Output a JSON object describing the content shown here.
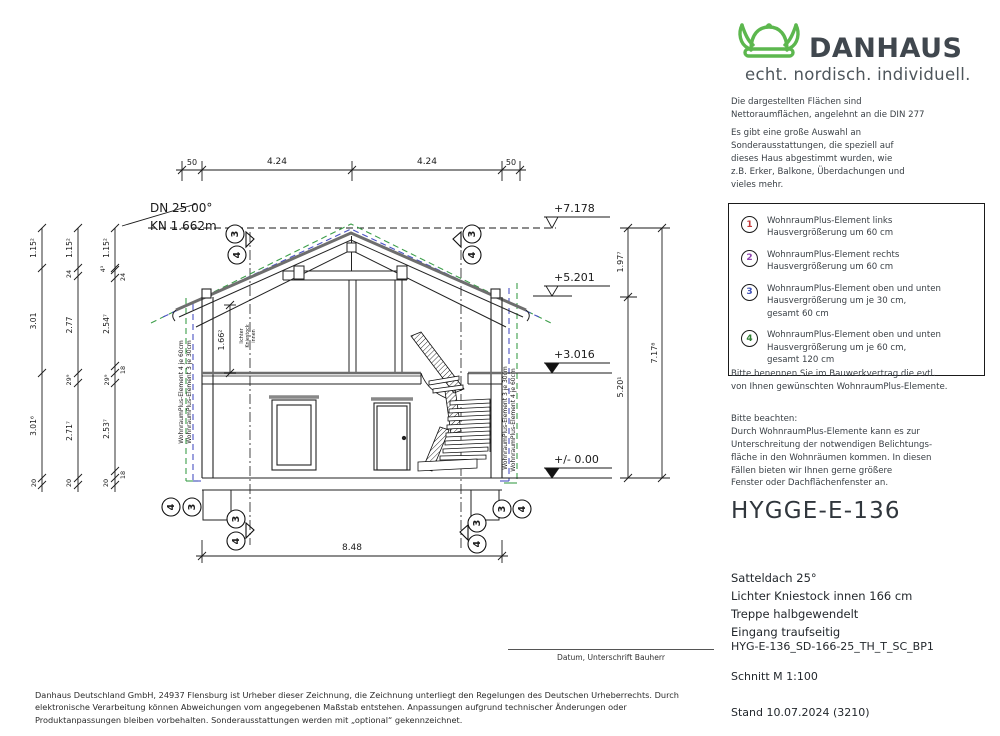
{
  "logo": {
    "brand": "DANHAUS",
    "tagline": "echt. nordisch. individuell."
  },
  "intro": {
    "p1_l1": "Die dargestellten Flächen sind",
    "p1_l2": "Nettoraumflächen, angelehnt an die DIN 277",
    "p2_l1": "Es gibt eine große Auswahl an",
    "p2_l2": "Sonderausstattungen, die speziell auf",
    "p2_l3": "dieses Haus abgestimmt wurden, wie",
    "p2_l4": "z.B. Erker, Balkone, Überdachungen und",
    "p2_l5": "vieles mehr."
  },
  "options_box": {
    "items": [
      {
        "num": "1",
        "color": "#c23b3b",
        "l1": "WohnraumPlus-Element links",
        "l2": "Hausvergrößerung um 60 cm",
        "l3": ""
      },
      {
        "num": "2",
        "color": "#8e44ad",
        "l1": "WohnraumPlus-Element rechts",
        "l2": "Hausvergrößerung um 60 cm",
        "l3": ""
      },
      {
        "num": "3",
        "color": "#3f51b5",
        "l1": "WohnraumPlus-Element oben und unten",
        "l2": "Hausvergrößerung um je 30 cm,",
        "l3": "gesamt 60 cm"
      },
      {
        "num": "4",
        "color": "#2e7d32",
        "l1": "WohnraumPlus-Element oben und unten",
        "l2": "Hausvergrößerung um je 60 cm,",
        "l3": "gesamt 120 cm"
      }
    ]
  },
  "notes": {
    "n1_l1": "Bitte benennen Sie im Bauwerkvertrag die evtl.",
    "n1_l2": "von Ihnen gewünschten WohnraumPlus-Elemente.",
    "n2_head": "Bitte beachten:",
    "n2_l1": "Durch WohnraumPlus-Elemente kann es zur",
    "n2_l2": "Unterschreitung der notwendigen Belichtungs-",
    "n2_l3": "fläche in den Wohnräumen kommen. In diesen",
    "n2_l4": "Fällen bieten wir Ihnen gerne größere",
    "n2_l5": "Fenster oder Dachflächenfenster an."
  },
  "product": {
    "title": "HYGGE-E-136",
    "spec1": "Satteldach 25°",
    "spec2": "Lichter Kniestock innen 166 cm",
    "spec3": "Treppe halbgewendelt",
    "spec4": "Eingang traufseitig",
    "code": "HYG-E-136_SD-166-25_TH_T_SC_BP1",
    "view": "Schnitt M 1:100",
    "stand": "Stand 10.07.2024 (3210)"
  },
  "signature": {
    "label": "Datum, Unterschrift Bauherr"
  },
  "footer": {
    "text": "Danhaus Deutschland GmbH, 24937 Flensburg ist Urheber dieser Zeichnung, die Zeichnung unterliegt den Regelungen des Deutschen Urheberrechts. Durch elektronische Verarbeitung können Abweichungen vom angegebenen Maßstab entstehen. Anpassungen aufgrund technischer Änderungen oder Produktanpassungen bleiben vorbehalten. Sonderausstattungen werden mit „optional“ gekennzeichnet."
  },
  "drawing": {
    "pitch": "DN 25.00°",
    "kniestock": "KN 1.662m",
    "top_dims": {
      "d1": "50",
      "d2": "4.24",
      "d3": "4.24",
      "d4": "50"
    },
    "levels": {
      "l1": "+7.178",
      "l2": "+5.201",
      "l3": "+3.016",
      "l4": "+/- 0.00"
    },
    "right_dims": {
      "r1": "1.97⁷",
      "r2": "5.20¹",
      "r3": "7.17⁸"
    },
    "bottom_dim": "8.48",
    "kniestock_dim": "1.66²",
    "kn_note1": "lichter",
    "kn_note2": "Kniestock",
    "kn_note3": "innen",
    "chain_a": {
      "v1": "1.15²",
      "v2": "3.01",
      "v3": "3.01⁶",
      "v4": "20"
    },
    "chain_b": {
      "v1": "1.15²",
      "v2": "24",
      "v3": "2.77",
      "v4": "29⁹",
      "v5": "2.71⁷",
      "v6": "20"
    },
    "chain_c": {
      "v1": "1.15²",
      "v2": "4³",
      "v3": "24",
      "v4": "2.54⁷",
      "v5": "18",
      "v6": "29⁹",
      "v7": "2.53⁷",
      "v8": "18",
      "v9": "20"
    },
    "plus_labels": {
      "left_green": "WohnraumPlus-Element 4 je 60cm",
      "left_blue": "WohnraumPlus-Element 3 je 30cm",
      "right_blue": "WohnraumPlus-Element 3 je 30cm",
      "right_green": "WohnraumPlus-Element 4 je 60cm"
    },
    "m3": "3",
    "m4": "4",
    "colors": {
      "blue": "#4a52c4",
      "green": "#3d9e4a",
      "line": "#1a1a1a"
    }
  }
}
